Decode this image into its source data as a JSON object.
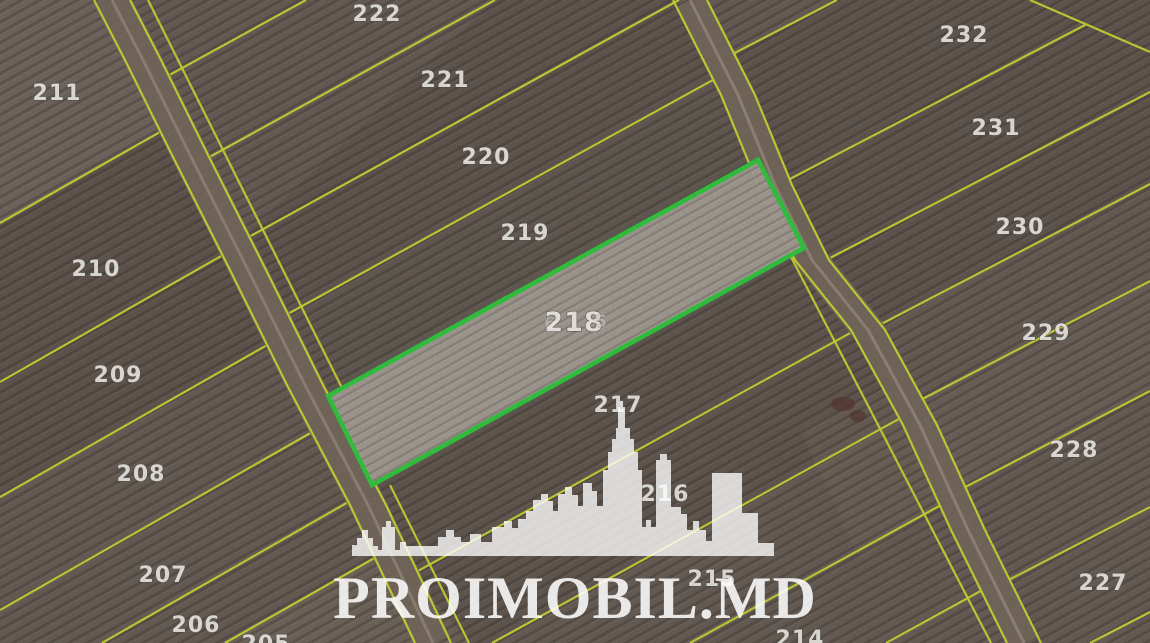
{
  "map": {
    "view": "satellite-cadastral",
    "parcels": [
      {
        "label": "211"
      },
      {
        "label": "210"
      },
      {
        "label": "209"
      },
      {
        "label": "208"
      },
      {
        "label": "207"
      },
      {
        "label": "206"
      },
      {
        "label": "205"
      },
      {
        "label": "222"
      },
      {
        "label": "221"
      },
      {
        "label": "220"
      },
      {
        "label": "219"
      },
      {
        "label": "218"
      },
      {
        "label": "217"
      },
      {
        "label": "216"
      },
      {
        "label": "215"
      },
      {
        "label": "214"
      },
      {
        "label": "232"
      },
      {
        "label": "231"
      },
      {
        "label": "230"
      },
      {
        "label": "229"
      },
      {
        "label": "228"
      },
      {
        "label": "227"
      }
    ],
    "highlighted_parcel": {
      "label": "218",
      "ghost_prefix": "6",
      "ghost_suffix": "5",
      "border_color": "#35d043",
      "fill_color": "#aea59d"
    },
    "colors": {
      "boundary_line": "#d3e138",
      "field_base": "#6d635b",
      "road": "#7b6e61",
      "label_text": "#e9e7e4"
    },
    "watermark": {
      "brand": "PROIMOBIL.MD",
      "logo": "city-skyline"
    }
  }
}
